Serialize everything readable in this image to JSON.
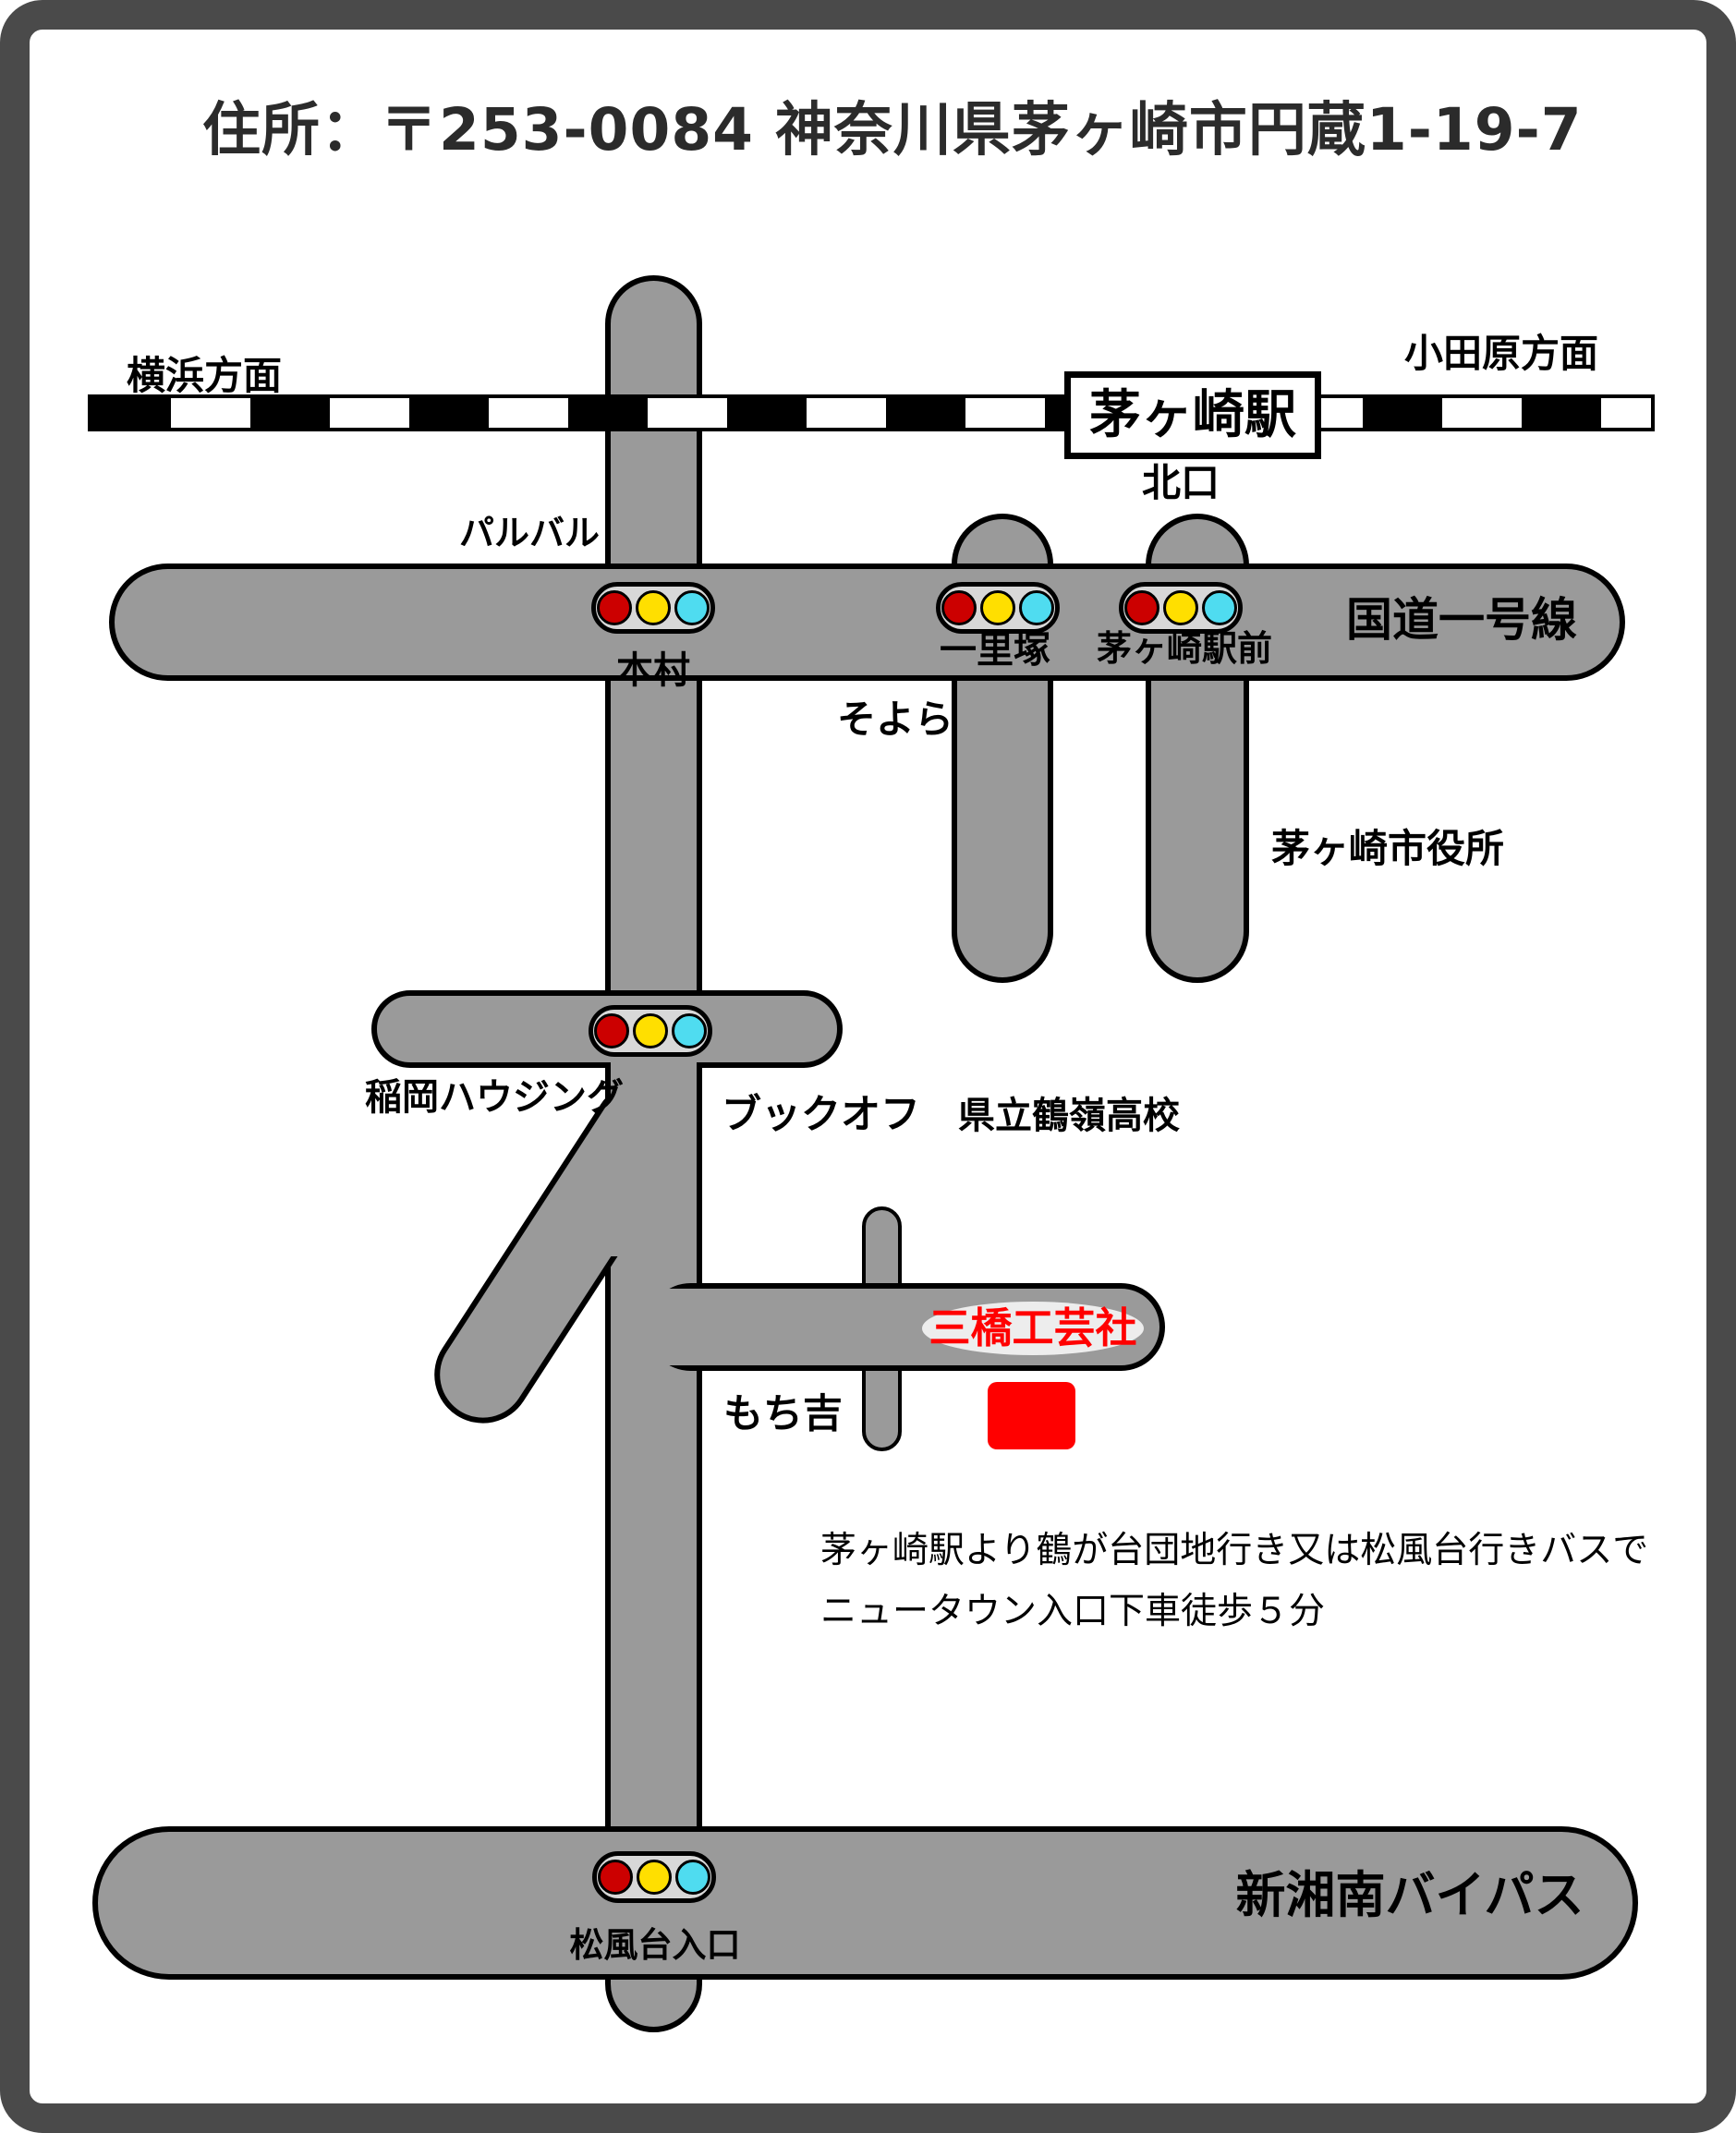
{
  "page": {
    "title": "住所：〒253-0084 神奈川県茅ヶ崎市円蔵1-19-7"
  },
  "colors": {
    "road_gray": "#9a9a9a",
    "frame_gray": "#4a4a4a",
    "signal_body": "#d8d8d8",
    "signal_red": "#cc0000",
    "signal_yellow": "#ffdf00",
    "signal_cyan": "#4fdcf0",
    "destination_red": "#ff0000"
  },
  "railway": {
    "left_direction": "横浜方面",
    "right_direction": "小田原方面",
    "station_name": "茅ヶ崎駅",
    "station_exit": "北口"
  },
  "roads": {
    "route1_label": "国道一号線",
    "bypass_label": "新湘南バイパス"
  },
  "intersections": {
    "honmura": "本村",
    "ichirizuka": "一里塚",
    "chigasaki_ekimae": "茅ヶ崎駅前",
    "inaoka_housing": "稲岡ハウジング",
    "matsukazedai_iriguchi": "松風台入口"
  },
  "landmarks": {
    "parubaru": "パルバル",
    "soyora": "そよら",
    "city_hall": "茅ヶ崎市役所",
    "bookoff": "ブックオフ",
    "tsurumine_hs": "県立鶴嶺高校",
    "mochikichi": "もち吉"
  },
  "destination": {
    "name": "三橋工芸社"
  },
  "directions": {
    "line1": "茅ヶ崎駅より鶴が台団地行き又は松風台行きバスで",
    "line2": "ニュータウン入口下車徒歩５分"
  }
}
